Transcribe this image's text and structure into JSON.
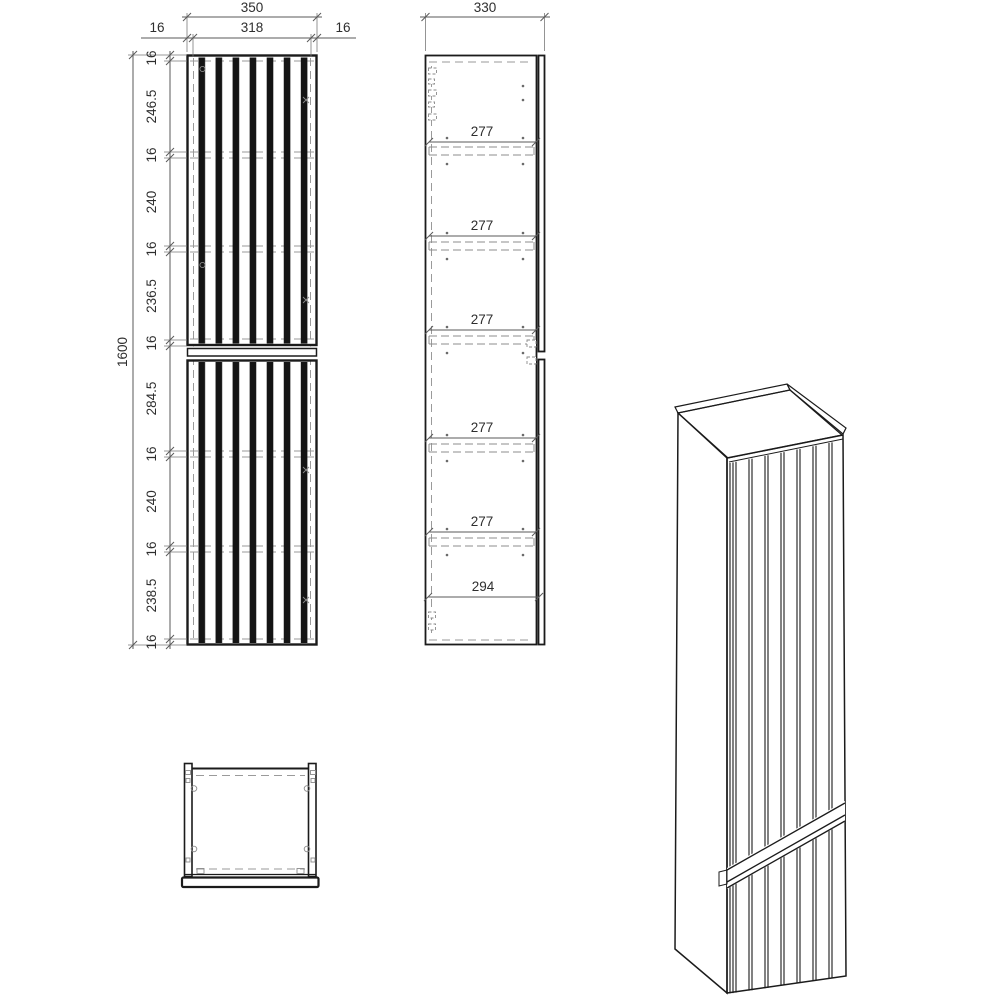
{
  "front_view": {
    "width_total": "350",
    "side_thickness_left": "16",
    "width_inner": "318",
    "side_thickness_right": "16",
    "height_total": "1600",
    "height_chain": [
      "16",
      "246.5",
      "16",
      "240",
      "16",
      "236.5",
      "16",
      "284.5",
      "16",
      "240",
      "16",
      "238.5",
      "16"
    ]
  },
  "section_view": {
    "depth_total": "330",
    "compartment_heights": [
      "277",
      "277",
      "277",
      "277",
      "277",
      "294"
    ]
  }
}
